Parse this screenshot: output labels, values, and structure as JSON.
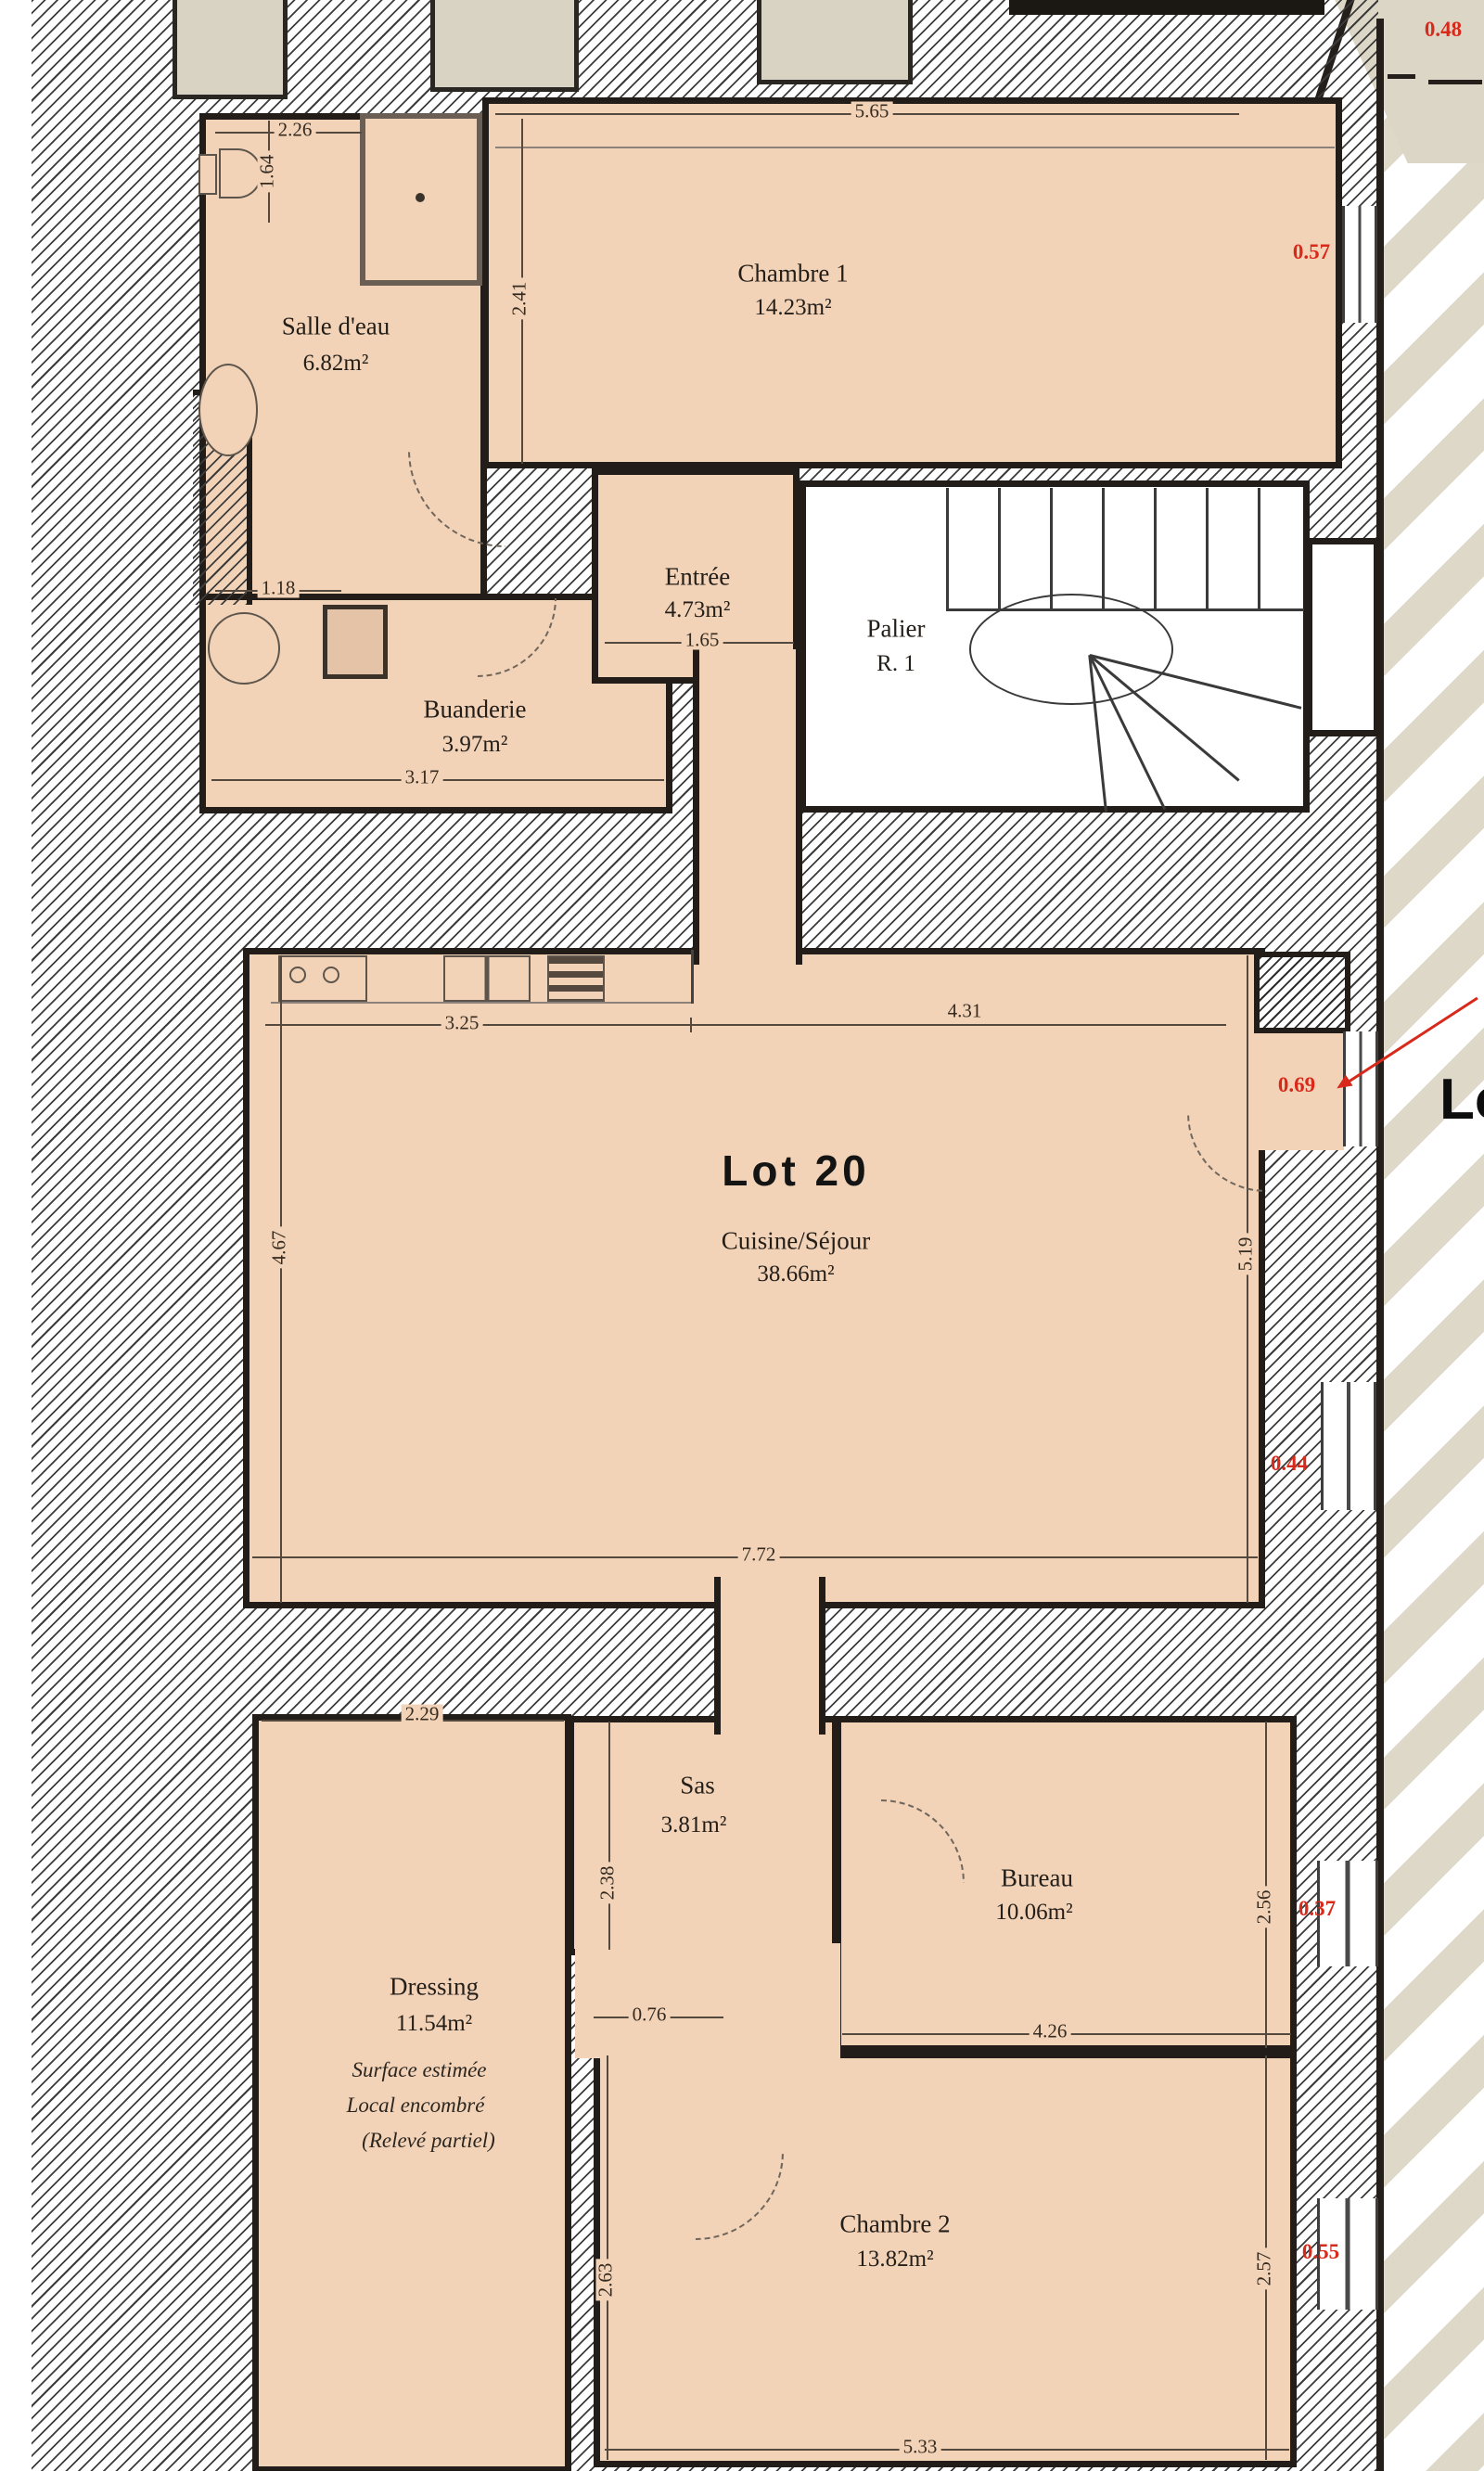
{
  "plan_title": "Lot 20",
  "neighbor_label_partial": "Lo",
  "rooms": {
    "salle_deau": {
      "name": "Salle d'eau",
      "area": "6.82m²"
    },
    "chambre1": {
      "name": "Chambre 1",
      "area": "14.23m²"
    },
    "entree": {
      "name": "Entrée",
      "area": "4.73m²"
    },
    "palier": {
      "name": "Palier",
      "level": "R. 1"
    },
    "buanderie": {
      "name": "Buanderie",
      "area": "3.97m²"
    },
    "cuisine": {
      "lot": "Lot 20",
      "name": "Cuisine/Séjour",
      "area": "38.66m²"
    },
    "dressing": {
      "name": "Dressing",
      "area": "11.54m²",
      "notes": [
        "Surface estimée",
        "Local encombré",
        "(Relevé partiel)"
      ]
    },
    "sas": {
      "name": "Sas",
      "area": "3.81m²"
    },
    "bureau": {
      "name": "Bureau",
      "area": "10.06m²"
    },
    "chambre2": {
      "name": "Chambre 2",
      "area": "13.82m²"
    }
  },
  "dims": [
    {
      "v": "2.26"
    },
    {
      "v": "5.65"
    },
    {
      "v": "2.41"
    },
    {
      "v": "1.64"
    },
    {
      "v": "1.18"
    },
    {
      "v": "1.65"
    },
    {
      "v": "3.17"
    },
    {
      "v": "3.25"
    },
    {
      "v": "4.31"
    },
    {
      "v": "4.67"
    },
    {
      "v": "5.19"
    },
    {
      "v": "7.72"
    },
    {
      "v": "2.29"
    },
    {
      "v": "2.38"
    },
    {
      "v": "0.76"
    },
    {
      "v": "4.26"
    },
    {
      "v": "2.56"
    },
    {
      "v": "5.33"
    },
    {
      "v": "2.57"
    },
    {
      "v": "2.63"
    }
  ],
  "red_dims": [
    {
      "v": "0.48"
    },
    {
      "v": "0.57"
    },
    {
      "v": "0.69"
    },
    {
      "v": "0.44"
    },
    {
      "v": "0.37"
    },
    {
      "v": "0.55"
    }
  ],
  "colors": {
    "room_fill": "#f2d3b8",
    "wall": "#221d18",
    "red_dimension": "#d8291a",
    "exterior_stripe": "#ded8c8"
  }
}
